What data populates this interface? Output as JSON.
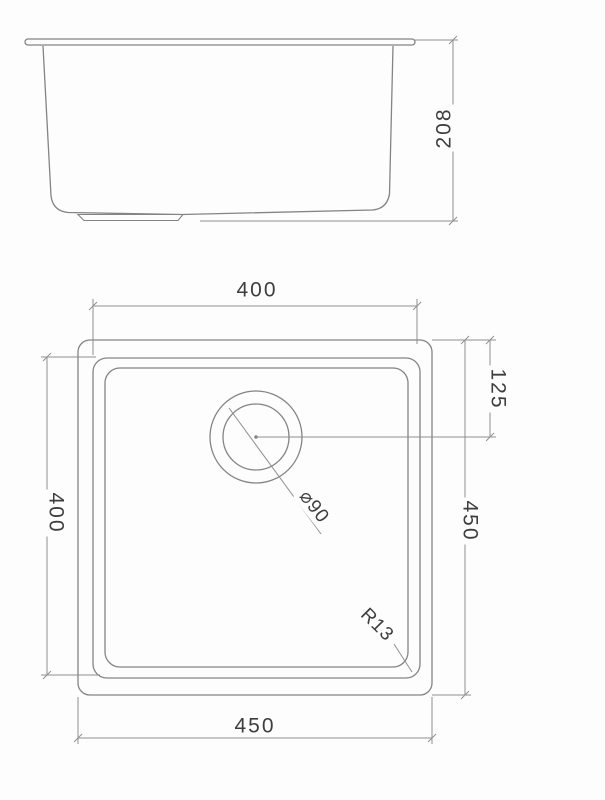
{
  "drawing": {
    "side_view": {
      "depth_label": "208"
    },
    "plan_view": {
      "top_width_label": "400",
      "left_height_label": "400",
      "right_overall_label": "450",
      "bottom_overall_label": "450",
      "drain_offset_label": "125",
      "drain_diameter_label": "⌀90",
      "corner_radius_label": "R13"
    },
    "colors": {
      "outline": "#848484",
      "dimension_line": "#909090",
      "text": "#3e3e3e",
      "background": "#fdfdfd"
    }
  }
}
